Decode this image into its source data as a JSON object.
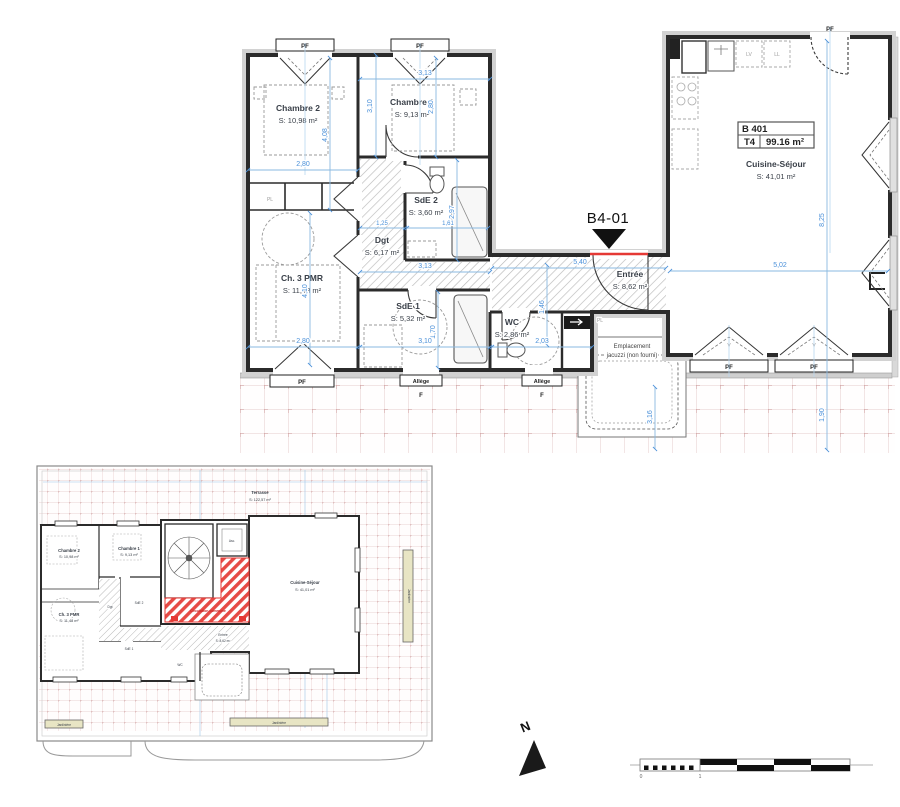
{
  "main_plan": {
    "unit_box": {
      "code": "B 401",
      "type": "T4",
      "area": "99.16 m²"
    },
    "marker_label": "B4-01",
    "rooms": {
      "chambre2": {
        "name": "Chambre 2",
        "area": "S: 10,98 m²"
      },
      "chambre1": {
        "name": "Chambre 1",
        "area": "S: 9,13 m²"
      },
      "sde2": {
        "name": "SdE 2",
        "area": "S: 3,60 m²"
      },
      "dgt": {
        "name": "Dgt",
        "area": "S: 6,17 m²"
      },
      "ch3pmr": {
        "name": "Ch. 3 PMR",
        "area": "S: 11,48 m²"
      },
      "sde1": {
        "name": "SdE 1",
        "area": "S: 5,32 m²"
      },
      "wc": {
        "name": "WC",
        "area": "S: 2,86 m²"
      },
      "entree": {
        "name": "Entrée",
        "area": "S: 8,62 m²"
      },
      "cuisine": {
        "name": "Cuisine-Séjour",
        "area": "S: 41,01 m²"
      }
    },
    "jacuzzi": {
      "line1": "Emplacement",
      "line2": "jacuzzi (non fourni)"
    },
    "labels": {
      "pf": "PF",
      "allege": "Allège",
      "f": "F",
      "v": "V",
      "pl": "PL",
      "lv": "LV",
      "ll": "LL"
    },
    "dims": [
      "2,80",
      "3,13",
      "3,10",
      "4,08",
      "2,80",
      "1,25",
      "2,97",
      "1,61",
      "3,13",
      "4,10",
      "1,70",
      "3,10",
      "2,80",
      "2,03",
      "1,46",
      "5,40",
      "5,02",
      "8,25",
      "1,90",
      "3,16"
    ]
  },
  "overview_plan": {
    "terrasse": {
      "name": "Terrasse",
      "area": "S: 122,57 m²"
    },
    "circulation": "Circulation commune",
    "asc": "Asc.",
    "jardiniere": "Jardinière"
  },
  "compass": {
    "north": "N"
  },
  "scale_bar": {
    "zero": "0",
    "one": "1"
  }
}
